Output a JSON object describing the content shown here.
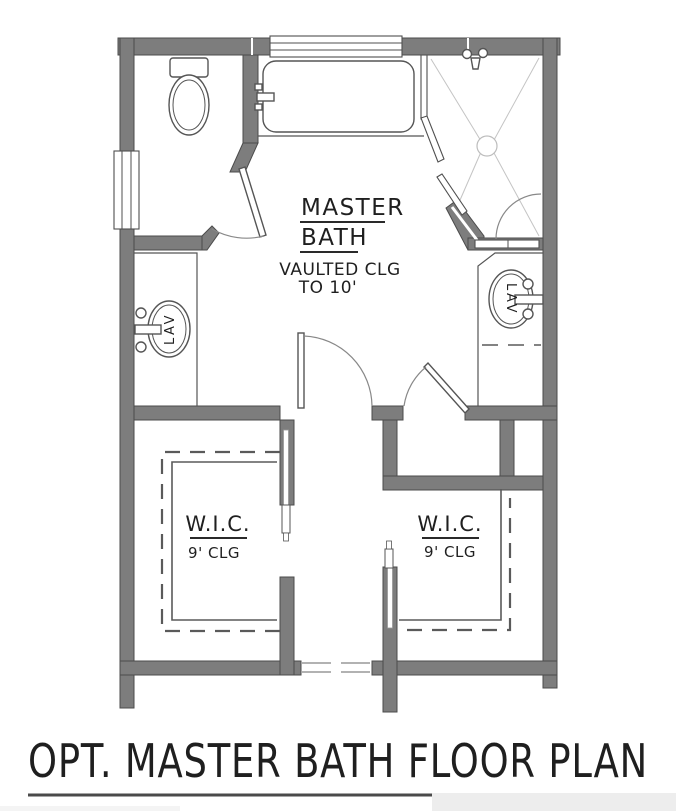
{
  "title": {
    "text": "OPT. MASTER BATH FLOOR PLAN"
  },
  "rooms": {
    "master_bath": {
      "name_line1": "MASTER",
      "name_line2": "BATH",
      "note_line1": "VAULTED CLG",
      "note_line2": "TO 10'"
    },
    "wic_left": {
      "name": "W.I.C.",
      "ceiling": "9' CLG"
    },
    "wic_right": {
      "name": "W.I.C.",
      "ceiling": "9' CLG"
    }
  },
  "fixtures": {
    "lav_left": {
      "label": "LAV"
    },
    "lav_right": {
      "label": "LAV"
    },
    "icons": [
      "toilet-icon",
      "bathtub-icon",
      "shower-icon",
      "shower-head-icon",
      "sink-icon",
      "window-icon",
      "door-swing-icon",
      "pocket-door-icon"
    ]
  },
  "colors": {
    "wall_fill": "#7d7d7d",
    "wall_outline": "#4b4b4b",
    "fixture_line": "#555555",
    "floor_line": "#c4c4c4",
    "text": "#1f1f1f",
    "background": "#ffffff"
  }
}
